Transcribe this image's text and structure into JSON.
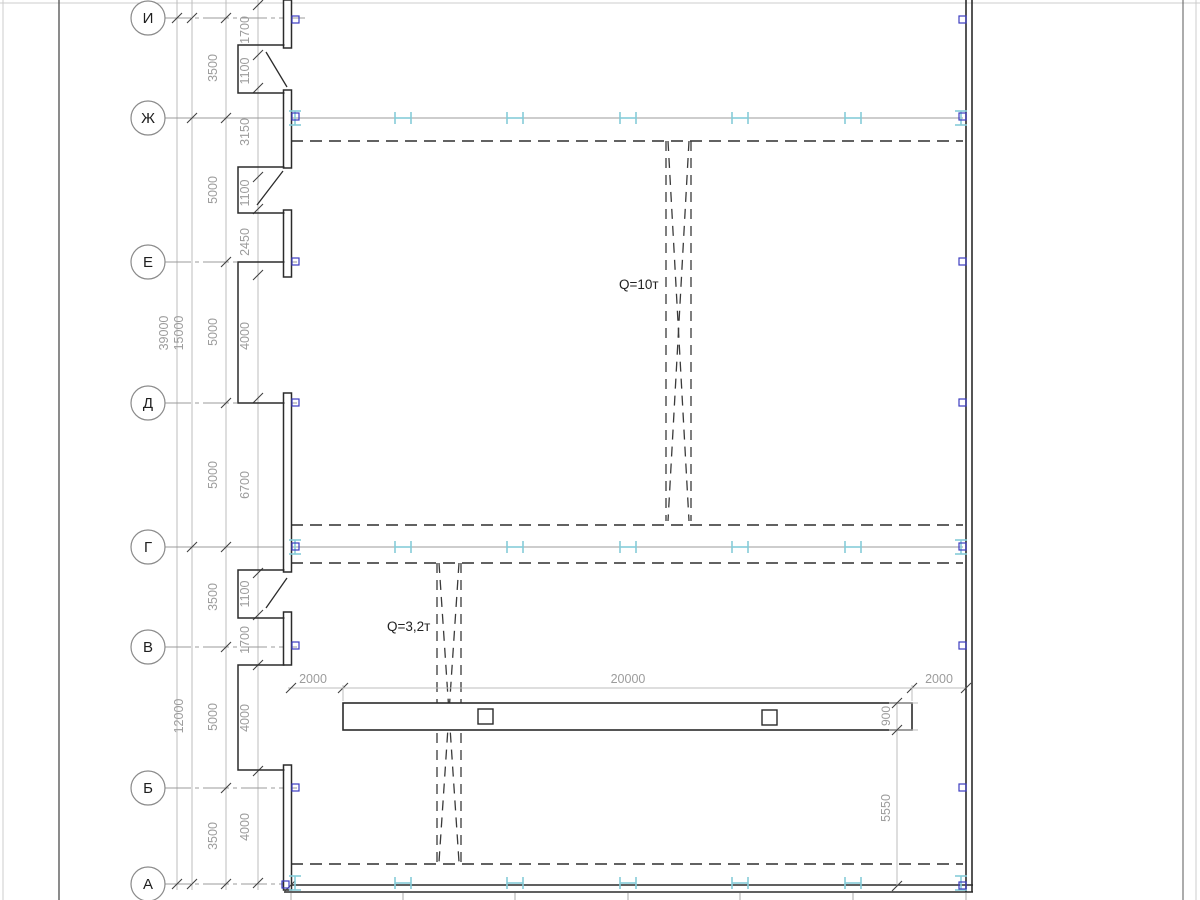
{
  "meta": {
    "description": "CAD plan of industrial building with overhead cranes"
  },
  "colors": {
    "page_edge": "#cccccc",
    "frame": "#5a5a5a",
    "wall": "#2b2b2b",
    "rail": "#2f2f2f",
    "crane": "#3a3a3a",
    "axis_line": "#9b9b9b",
    "chain_line": "#bdbdbd",
    "tick": "#404040",
    "dim_text": "#9c9c9c",
    "circle_stroke": "#8a8a8a",
    "axis_text": "#1f1f1f",
    "ibeam": "#85ccd8",
    "marker": "#3d3dc0",
    "stub": "#a9a9a9",
    "label_text": "#222222"
  },
  "frame": {
    "page_left_x": 3,
    "page_top_y": 3,
    "border_left_x": 59,
    "border_right_x": 1183,
    "page_right_x": 1196
  },
  "circle": {
    "cx": 148,
    "r": 17,
    "font_size": 15
  },
  "axes": [
    {
      "label": "И",
      "y": 18,
      "line_end": 305,
      "row": false
    },
    {
      "label": "Ж",
      "y": 118,
      "line_end": 963,
      "row": true
    },
    {
      "label": "Е",
      "y": 262,
      "line_end": 297,
      "row": false
    },
    {
      "label": "Д",
      "y": 403,
      "line_end": 297,
      "row": false
    },
    {
      "label": "Г",
      "y": 547,
      "line_end": 963,
      "row": true
    },
    {
      "label": "В",
      "y": 647,
      "line_end": 297,
      "row": false
    },
    {
      "label": "Б",
      "y": 788,
      "line_end": 297,
      "row": false
    },
    {
      "label": "А",
      "y": 884,
      "line_end": 284,
      "row": false
    }
  ],
  "dim_chains": [
    {
      "x": 177,
      "ticks": [
        18,
        884
      ],
      "labels": [
        {
          "text": "39000",
          "y": 333
        }
      ]
    },
    {
      "x": 192,
      "ticks": [
        18,
        118,
        547,
        884
      ],
      "labels": [
        {
          "text": "15000",
          "y": 333
        },
        {
          "text": "12000",
          "y": 716
        }
      ]
    },
    {
      "x": 226,
      "ticks": [
        18,
        118,
        262,
        403,
        547,
        647,
        788,
        884
      ],
      "labels": [
        {
          "text": "3500",
          "y": 68
        },
        {
          "text": "5000",
          "y": 190
        },
        {
          "text": "5000",
          "y": 332
        },
        {
          "text": "5000",
          "y": 475
        },
        {
          "text": "3500",
          "y": 597
        },
        {
          "text": "5000",
          "y": 717
        },
        {
          "text": "3500",
          "y": 836
        }
      ]
    },
    {
      "x": 258,
      "ticks": [
        5,
        55,
        88,
        177,
        209,
        275,
        398,
        573,
        615,
        665,
        771,
        883
      ],
      "labels": [
        {
          "text": "1700",
          "y": 30
        },
        {
          "text": "1100",
          "y": 71
        },
        {
          "text": "3150",
          "y": 132
        },
        {
          "text": "1100",
          "y": 193
        },
        {
          "text": "2450",
          "y": 242
        },
        {
          "text": "4000",
          "y": 336
        },
        {
          "text": "6700",
          "y": 485
        },
        {
          "text": "1100",
          "y": 594
        },
        {
          "text": "1700",
          "y": 640
        },
        {
          "text": "4000",
          "y": 718
        },
        {
          "text": "4000",
          "y": 827
        }
      ]
    }
  ],
  "walls": {
    "right_x1": 966,
    "right_x2": 972,
    "right_y_top": 0,
    "right_y_bot": 892,
    "bottom_y1": 885,
    "bottom_y2": 892,
    "bottom_x_left": 284,
    "bottom_x_right": 973,
    "panel_x": 283.5,
    "panel_w": 8,
    "panels": [
      [
        0,
        48
      ],
      [
        90,
        168
      ],
      [
        210,
        277
      ],
      [
        393,
        572
      ],
      [
        612,
        665
      ],
      [
        765,
        890
      ]
    ],
    "recess_x": 238,
    "recess_boxes": [
      [
        45,
        93
      ],
      [
        167,
        213
      ],
      [
        262,
        403
      ],
      [
        570,
        618
      ],
      [
        665,
        770
      ]
    ],
    "door_diagonals": [
      [
        266,
        52,
        287,
        87
      ],
      [
        283,
        171,
        257,
        205
      ],
      [
        287,
        578,
        266,
        608
      ]
    ]
  },
  "rails": {
    "ys": [
      141,
      525,
      563,
      864
    ],
    "x1": 291,
    "x2": 963
  },
  "ibeams": {
    "rows": [
      118,
      547,
      883
    ],
    "mid_xs": [
      403,
      515,
      628,
      740,
      853
    ],
    "left_x": 295,
    "right_x": 961
  },
  "col_markers": {
    "size": 7,
    "left_x": 292,
    "right_x": 959,
    "left_ys": [
      16,
      113,
      258,
      399,
      543,
      642,
      784
    ],
    "left_corner": [
      282,
      881
    ],
    "right_ys": [
      16,
      113,
      258,
      399,
      543,
      642,
      784,
      882
    ]
  },
  "grid_stubs": {
    "xs": [
      291,
      403,
      515,
      628,
      740,
      853,
      966
    ],
    "y1": 893,
    "y2": 900
  },
  "cranes": [
    {
      "label": "Q=10т",
      "x1": 666,
      "x2": 691,
      "y1": 141,
      "y2": 521,
      "label_x": 619,
      "label_y": 289
    },
    {
      "label": "Q=3,2т",
      "x1": 437,
      "x2": 461,
      "y1": 563,
      "y2": 862,
      "label_x": 387,
      "label_y": 631
    }
  ],
  "monorail": {
    "x": 343,
    "y": 703,
    "w": 569,
    "h": 27,
    "squares": [
      [
        478,
        709,
        15
      ],
      [
        762,
        710,
        15
      ]
    ]
  },
  "beam_dims": {
    "line_y": 688,
    "label_y": 683,
    "ticks_x": [
      291,
      343,
      912,
      966
    ],
    "labels": [
      {
        "text": "2000",
        "x": 313
      },
      {
        "text": "20000",
        "x": 628
      },
      {
        "text": "2000",
        "x": 939
      }
    ],
    "v_x": 897,
    "dim900": {
      "text": "900",
      "y1": 703,
      "y2": 730,
      "label_y": 716
    },
    "dim5550": {
      "text": "5550",
      "y1": 730,
      "y2": 886,
      "label_y": 808
    }
  }
}
